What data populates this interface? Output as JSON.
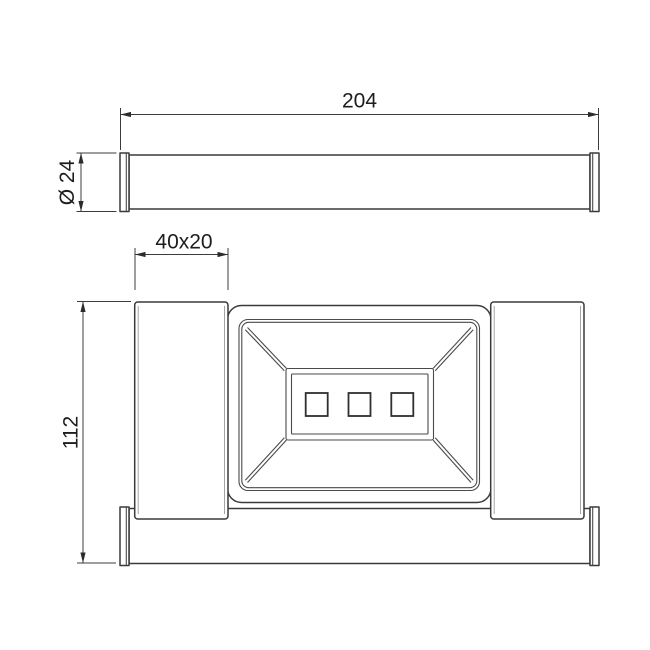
{
  "drawing": {
    "dimensions": {
      "bar_length": "204",
      "bar_diameter": "Ø 24",
      "post_section": "40x20",
      "overall_height": "112"
    },
    "colors": {
      "line": "#3a3a3a",
      "dimension_line": "#3c3c3c",
      "text": "#1d1d1d",
      "background": "#ffffff"
    }
  }
}
